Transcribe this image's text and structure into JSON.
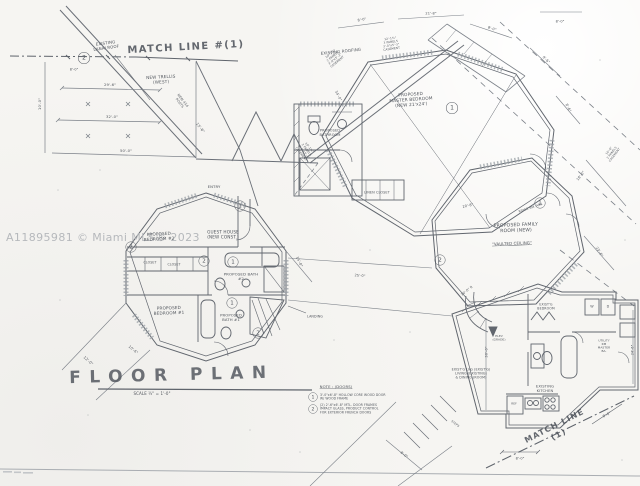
{
  "watermark": "A11895981 © Miami MLS® 2023",
  "labels": [
    {
      "name": "match-line-top-label",
      "text": "MATCH LINE #(1)"
    },
    {
      "name": "existing-lanai-roof-label",
      "text": "EXISTING\nLANAI ROOF"
    },
    {
      "name": "existing-roofing-label",
      "text": "EXISTING ROOFING"
    },
    {
      "name": "new-trellis-label",
      "text": "NEW TRELLIS\n(WEST)"
    },
    {
      "name": "dim-29-6",
      "text": "29'-6\""
    },
    {
      "name": "dim-32-0",
      "text": "32'-0\""
    },
    {
      "name": "dim-50-0",
      "text": "50'-0\""
    },
    {
      "name": "dim-10-0",
      "text": "10'-0\""
    },
    {
      "name": "posts-label",
      "text": "NEW 4X4\nPOSTS"
    },
    {
      "name": "dim-15-6",
      "text": "15'-6\""
    },
    {
      "name": "dim-8-0-a",
      "text": "8'-0\""
    },
    {
      "name": "entry-label",
      "text": "ENTRY"
    },
    {
      "name": "guest-house-label",
      "text": "GUEST HOUSE\n(NEW CONST.)"
    },
    {
      "name": "bedroom2-label",
      "text": "PROPOSED\nBEDROOM #2"
    },
    {
      "name": "closet-a-label",
      "text": "CLOSET"
    },
    {
      "name": "closet-b-label",
      "text": "CLOSET"
    },
    {
      "name": "bath2-label",
      "text": "PROPOSED BATH\n#2"
    },
    {
      "name": "bedroom1-label",
      "text": "PROPOSED\nBEDROOM #1"
    },
    {
      "name": "bath1-label",
      "text": "PROPOSED\nBATH #1"
    },
    {
      "name": "landing-label",
      "text": "LANDING"
    },
    {
      "name": "dim-12-0",
      "text": "12'-0\""
    },
    {
      "name": "dim-10-6",
      "text": "10'-6\""
    },
    {
      "name": "dim-15-0",
      "text": "15'-0\""
    },
    {
      "name": "floor-plan-title",
      "text": "FLOOR PLAN"
    },
    {
      "name": "floor-plan-scale",
      "text": "SCALE ¼\" = 1'-0\""
    },
    {
      "name": "note-heading",
      "text": "NOTE : (DOORS)"
    },
    {
      "name": "note-1",
      "text": "3'-0\"x6'-8\" HOLLOW CORE WOOD DOOR\nW/ WOOD FRAME"
    },
    {
      "name": "note-2",
      "text": "(2) 2'-6\"x6'-8\" MTL. DOOR FRAMES\nIMPACT GLASS, PRODUCT CONTROL\nFOR EXTERIOR FRENCH DOORS"
    },
    {
      "name": "master-bedroom-label",
      "text": "PROPOSED\nMASTER BEDROOM\n(NEW 21'x24')"
    },
    {
      "name": "proposed-bathroom-label",
      "text": "PROPOSED\nBATHROOM"
    },
    {
      "name": "linen-closet-label",
      "text": "LINEN CLOSET"
    },
    {
      "name": "window-spec-a",
      "text": "10'-1¾\"\n2 PANELS\n3'-0\"x5'-3\"\nCASEMENT"
    },
    {
      "name": "window-spec-b",
      "text": "12'-1¾\"\n3 PANELS\n3'-0\"x5'-3\"\nCASEMENT"
    },
    {
      "name": "window-spec-c",
      "text": "10'-1¾\"\n2 PANELS\n3'-0\"x5'-3\"\nCASEMENT"
    },
    {
      "name": "window-spec-d",
      "text": "10'-6\"\n2 PANELS\nCASEMENT"
    },
    {
      "name": "dim-8-0-b",
      "text": "8'-0\""
    },
    {
      "name": "dim-21-8",
      "text": "21'-8\""
    },
    {
      "name": "dim-8-0-c",
      "text": "8'-0\""
    },
    {
      "name": "dim-9-6",
      "text": "9'-6\""
    },
    {
      "name": "dim-8-6",
      "text": "8'-6\""
    },
    {
      "name": "ridge-beam-label",
      "text": "RIDGE BM. ABV."
    },
    {
      "name": "dim-20-8",
      "text": "20'-8\""
    },
    {
      "name": "dim-34-0",
      "text": "34'-0\""
    },
    {
      "name": "family-room-label",
      "text": "PROPOSED FAMILY\nROOM (NEW)"
    },
    {
      "name": "vaulted-ceiling-label",
      "text": "\"VAULTED CEILING\""
    },
    {
      "name": "dim-23-6",
      "text": "23'-6\""
    },
    {
      "name": "dim-16-0-r",
      "text": "16'-0\" R"
    },
    {
      "name": "dim-18-0",
      "text": "18'-0\""
    },
    {
      "name": "existing-living-label",
      "text": "EXIST'G LVG (EXIST'G)\nLIVING (EXISTING)\n& DINING (ROOM)"
    },
    {
      "name": "existing-kitchen-label",
      "text": "EXISTING KITCHEN"
    },
    {
      "name": "existing-bedroom-label",
      "text": "EXIST'G\nBEDROOM"
    },
    {
      "name": "utility-room-label",
      "text": "UTILITY RM\nMASTER BA."
    },
    {
      "name": "elevation-label",
      "text": "ELEV\n(GRADE)"
    },
    {
      "name": "match-line-bottom-label",
      "text": "MATCH LINE (1)"
    },
    {
      "name": "dim-8-0-d",
      "text": "8'-0\""
    },
    {
      "name": "dim-8-0-e",
      "text": "8'-0\""
    },
    {
      "name": "dim-30-0",
      "text": "30'-0\""
    },
    {
      "name": "dim-25-0",
      "text": "25'-0\""
    },
    {
      "name": "dim-8-0-f",
      "text": "8'-0\""
    },
    {
      "name": "steps-label",
      "text": "STEPS"
    },
    {
      "name": "dim-24-6",
      "text": "24'-6\""
    },
    {
      "name": "refrigerator-label",
      "text": "REF"
    },
    {
      "name": "washer-label",
      "text": "W"
    },
    {
      "name": "dryer-label",
      "text": "D"
    },
    {
      "name": "dim-8-0-g",
      "text": "8'-0\""
    }
  ],
  "markers": [
    {
      "num": "2"
    },
    {
      "num": "1"
    },
    {
      "num": "2"
    },
    {
      "num": "2"
    },
    {
      "num": "1"
    },
    {
      "num": "1"
    },
    {
      "num": "2"
    },
    {
      "num": "1"
    },
    {
      "num": "1"
    },
    {
      "num": "2"
    },
    {
      "num": "1"
    },
    {
      "num": "2"
    }
  ]
}
